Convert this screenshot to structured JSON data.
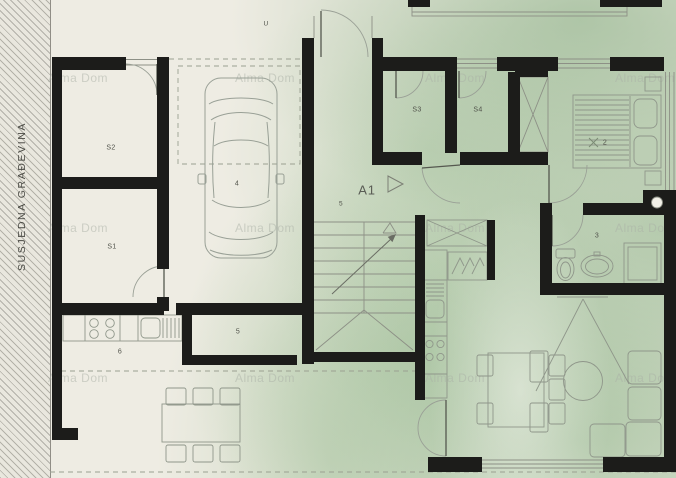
{
  "page": {
    "type": "architectural floor plan scan"
  },
  "labels": {
    "neighbor_building": "SUSJEDNA GRAĐEVINA",
    "entrance": "U",
    "room_s2": "S2",
    "room_s1": "S1",
    "garage": "4",
    "kitchen": "6",
    "corridor": "5",
    "hall": "5",
    "apartment": "A1",
    "storage_s3": "S3",
    "storage_s4": "S4",
    "bathroom": "3",
    "bedroom": "2"
  },
  "watermark": {
    "text": "Alma Dom"
  },
  "colors": {
    "paper": "#eeece3",
    "wall": "#1c1c1a",
    "thin_line": "#8d9086",
    "wash_green": "#96b890",
    "label": "#50524a"
  }
}
